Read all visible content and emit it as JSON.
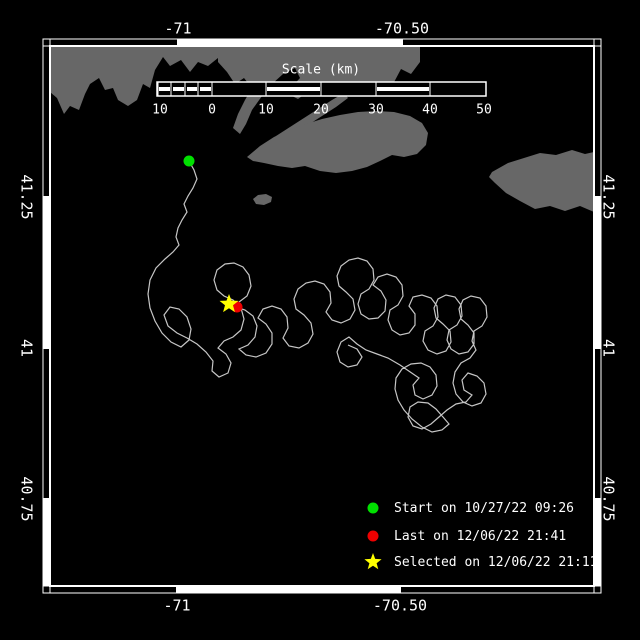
{
  "figure": {
    "background": "#000000",
    "land_color": "#676767",
    "track_color": "#c6c6c6",
    "frame_color": "#ffffff",
    "text_color": "#ffffff"
  },
  "axes": {
    "top": [
      {
        "label": "-71",
        "x": 178
      },
      {
        "label": "-70.50",
        "x": 402
      }
    ],
    "bottom": [
      {
        "label": "-71",
        "x": 177
      },
      {
        "label": "-70.50",
        "x": 400
      }
    ],
    "left": [
      {
        "label": "41.25",
        "y": 197
      },
      {
        "label": "41",
        "y": 348
      },
      {
        "label": "40.75",
        "y": 499
      }
    ],
    "right": [
      {
        "label": "41.25",
        "y": 197
      },
      {
        "label": "41",
        "y": 348
      },
      {
        "label": "40.75",
        "y": 499
      }
    ]
  },
  "border": {
    "frame": {
      "x1": 50,
      "y1": 46,
      "x2": 594,
      "y2": 586
    },
    "band": 7,
    "top": {
      "ticks": [
        178,
        402
      ],
      "white": [
        [
          178,
          402
        ]
      ]
    },
    "bottom": {
      "ticks": [
        177,
        400
      ],
      "white": [
        [
          177,
          400
        ]
      ]
    },
    "left": {
      "ticks": [
        197,
        348,
        499
      ],
      "white": [
        [
          197,
          348
        ],
        [
          499,
          586
        ]
      ]
    },
    "right": {
      "ticks": [
        197,
        348,
        499
      ],
      "white": [
        [
          197,
          348
        ],
        [
          499,
          586
        ]
      ]
    }
  },
  "scalebar": {
    "title": "Scale (km)",
    "title_x": 321,
    "title_y": 70,
    "bar": {
      "x1": 157,
      "y1": 82,
      "x2": 486,
      "y2": 96
    },
    "stripe_y": [
      87,
      91
    ],
    "dividers": [
      158,
      171,
      185,
      198,
      212,
      266,
      321,
      376,
      430
    ],
    "stripes": [
      [
        159,
        170
      ],
      [
        173,
        184
      ],
      [
        187,
        197
      ],
      [
        200,
        211
      ],
      [
        267,
        320
      ],
      [
        377,
        429
      ]
    ],
    "ticks": [
      {
        "label": "10",
        "x": 160
      },
      {
        "label": "0",
        "x": 212
      },
      {
        "label": "10",
        "x": 266
      },
      {
        "label": "20",
        "x": 321
      },
      {
        "label": "30",
        "x": 376
      },
      {
        "label": "40",
        "x": 430
      },
      {
        "label": "50",
        "x": 484
      }
    ],
    "tick_y": 110
  },
  "markers": {
    "start": {
      "x": 189,
      "y": 161,
      "r": 5.5,
      "color": "#00e000"
    },
    "last": {
      "x": 237,
      "y": 307,
      "r": 5.5,
      "color": "#ee0000"
    },
    "selected": {
      "x": 229,
      "y": 304,
      "r": 10,
      "color": "#ffff00"
    }
  },
  "legend": {
    "x": 360,
    "items": [
      {
        "marker": "circle",
        "color": "#00e000",
        "y": 508,
        "label": "Start on 10/27/22 09:26"
      },
      {
        "marker": "circle",
        "color": "#ee0000",
        "y": 536,
        "label": "Last on 12/06/22 21:41"
      },
      {
        "marker": "star",
        "color": "#ffff00",
        "y": 562,
        "label": "Selected on 12/06/22 21:11"
      }
    ]
  },
  "land": [
    {
      "name": "landmass-mainland-west",
      "points": "50,46 218,46 218,58 208,66 198,62 190,72 181,60 170,66 163,57 155,70 150,88 143,84 137,100 128,106 118,100 113,88 105,90 99,78 90,84 85,94 79,110 70,106 64,114 57,98 50,92"
    },
    {
      "name": "landmass-mainland-east",
      "points": "218,46 420,46 420,62 411,74 401,69 392,86 379,91 365,84 350,93 336,88 322,96 309,91 298,99 286,93 300,78 295,68 283,74 272,84 262,96 252,110 246,124 240,134 233,128 238,114 245,100 252,88 244,78 235,84 227,72 218,62"
    },
    {
      "name": "landmass-elizabeth-islands",
      "points": "262,146 276,136 290,127 304,118 318,109 332,100 344,93 348,98 336,107 322,116 308,125 294,134 280,143 268,152"
    },
    {
      "name": "landmass-marthas-vineyard",
      "points": "247,157 260,146 274,137 290,130 306,124 322,119 340,115 358,112 376,111 394,112 410,116 422,123 428,133 426,145 417,154 404,157 392,155 380,161 367,167 352,171 336,173 320,171 305,166 292,168 278,166 264,163 253,161"
    },
    {
      "name": "landmass-nantucket",
      "points": "492,172 508,163 524,158 540,153 556,155 572,150 585,154 594,152 594,212 580,206 565,211 550,206 535,209 520,201 506,193 495,183 489,177"
    },
    {
      "name": "landmass-small-island",
      "points": "253,199 258,195 266,194 272,197 271,202 264,205 256,204"
    }
  ],
  "track": [
    [
      189,
      161
    ],
    [
      194,
      170
    ],
    [
      197,
      179
    ],
    [
      193,
      188
    ],
    [
      188,
      196
    ],
    [
      184,
      204
    ],
    [
      187,
      212
    ],
    [
      182,
      220
    ],
    [
      178,
      228
    ],
    [
      176,
      237
    ],
    [
      179,
      245
    ],
    [
      173,
      252
    ],
    [
      165,
      259
    ],
    [
      156,
      268
    ],
    [
      150,
      280
    ],
    [
      148,
      294
    ],
    [
      150,
      308
    ],
    [
      155,
      321
    ],
    [
      162,
      333
    ],
    [
      171,
      342
    ],
    [
      181,
      347
    ],
    [
      189,
      340
    ],
    [
      191,
      329
    ],
    [
      187,
      317
    ],
    [
      179,
      309
    ],
    [
      170,
      307
    ],
    [
      164,
      315
    ],
    [
      168,
      326
    ],
    [
      177,
      333
    ],
    [
      187,
      338
    ],
    [
      197,
      344
    ],
    [
      206,
      352
    ],
    [
      213,
      361
    ],
    [
      212,
      371
    ],
    [
      219,
      377
    ],
    [
      228,
      373
    ],
    [
      231,
      363
    ],
    [
      226,
      354
    ],
    [
      218,
      348
    ],
    [
      224,
      341
    ],
    [
      233,
      337
    ],
    [
      241,
      330
    ],
    [
      244,
      319
    ],
    [
      241,
      308
    ],
    [
      233,
      300
    ],
    [
      224,
      296
    ],
    [
      217,
      290
    ],
    [
      214,
      280
    ],
    [
      217,
      270
    ],
    [
      225,
      264
    ],
    [
      234,
      263
    ],
    [
      243,
      267
    ],
    [
      249,
      275
    ],
    [
      251,
      286
    ],
    [
      247,
      296
    ],
    [
      239,
      302
    ],
    [
      236,
      307
    ],
    [
      245,
      310
    ],
    [
      253,
      316
    ],
    [
      257,
      326
    ],
    [
      255,
      337
    ],
    [
      248,
      345
    ],
    [
      239,
      349
    ],
    [
      246,
      355
    ],
    [
      256,
      357
    ],
    [
      266,
      353
    ],
    [
      272,
      344
    ],
    [
      272,
      333
    ],
    [
      266,
      324
    ],
    [
      258,
      318
    ],
    [
      263,
      309
    ],
    [
      272,
      306
    ],
    [
      281,
      309
    ],
    [
      287,
      317
    ],
    [
      288,
      328
    ],
    [
      283,
      338
    ],
    [
      289,
      346
    ],
    [
      299,
      348
    ],
    [
      308,
      343
    ],
    [
      313,
      334
    ],
    [
      311,
      323
    ],
    [
      304,
      315
    ],
    [
      296,
      309
    ],
    [
      294,
      299
    ],
    [
      298,
      289
    ],
    [
      306,
      283
    ],
    [
      315,
      281
    ],
    [
      324,
      284
    ],
    [
      330,
      292
    ],
    [
      331,
      303
    ],
    [
      326,
      312
    ],
    [
      332,
      320
    ],
    [
      341,
      323
    ],
    [
      350,
      319
    ],
    [
      355,
      310
    ],
    [
      353,
      299
    ],
    [
      346,
      292
    ],
    [
      339,
      286
    ],
    [
      337,
      276
    ],
    [
      341,
      266
    ],
    [
      349,
      260
    ],
    [
      358,
      258
    ],
    [
      367,
      261
    ],
    [
      373,
      269
    ],
    [
      374,
      280
    ],
    [
      369,
      289
    ],
    [
      361,
      294
    ],
    [
      358,
      304
    ],
    [
      361,
      314
    ],
    [
      369,
      319
    ],
    [
      378,
      318
    ],
    [
      385,
      311
    ],
    [
      386,
      300
    ],
    [
      381,
      291
    ],
    [
      373,
      285
    ],
    [
      378,
      277
    ],
    [
      387,
      274
    ],
    [
      396,
      277
    ],
    [
      402,
      285
    ],
    [
      403,
      296
    ],
    [
      398,
      305
    ],
    [
      390,
      310
    ],
    [
      388,
      320
    ],
    [
      392,
      330
    ],
    [
      400,
      335
    ],
    [
      409,
      333
    ],
    [
      415,
      325
    ],
    [
      415,
      314
    ],
    [
      409,
      306
    ],
    [
      413,
      297
    ],
    [
      422,
      295
    ],
    [
      431,
      298
    ],
    [
      437,
      306
    ],
    [
      438,
      317
    ],
    [
      433,
      326
    ],
    [
      425,
      331
    ],
    [
      423,
      341
    ],
    [
      428,
      350
    ],
    [
      437,
      354
    ],
    [
      446,
      351
    ],
    [
      451,
      342
    ],
    [
      450,
      331
    ],
    [
      443,
      324
    ],
    [
      436,
      318
    ],
    [
      434,
      308
    ],
    [
      438,
      299
    ],
    [
      446,
      295
    ],
    [
      455,
      297
    ],
    [
      461,
      305
    ],
    [
      462,
      316
    ],
    [
      457,
      325
    ],
    [
      449,
      330
    ],
    [
      447,
      340
    ],
    [
      451,
      349
    ],
    [
      459,
      354
    ],
    [
      468,
      352
    ],
    [
      474,
      344
    ],
    [
      474,
      333
    ],
    [
      468,
      325
    ],
    [
      461,
      319
    ],
    [
      459,
      309
    ],
    [
      463,
      300
    ],
    [
      471,
      296
    ],
    [
      480,
      298
    ],
    [
      486,
      306
    ],
    [
      487,
      317
    ],
    [
      482,
      326
    ],
    [
      474,
      331
    ],
    [
      472,
      341
    ],
    [
      476,
      350
    ],
    [
      470,
      358
    ],
    [
      461,
      363
    ],
    [
      455,
      372
    ],
    [
      453,
      383
    ],
    [
      456,
      394
    ],
    [
      463,
      402
    ],
    [
      472,
      406
    ],
    [
      481,
      403
    ],
    [
      486,
      394
    ],
    [
      484,
      383
    ],
    [
      477,
      376
    ],
    [
      468,
      373
    ],
    [
      462,
      380
    ],
    [
      464,
      390
    ],
    [
      472,
      395
    ],
    [
      466,
      402
    ],
    [
      456,
      404
    ],
    [
      447,
      410
    ],
    [
      439,
      417
    ],
    [
      431,
      424
    ],
    [
      422,
      429
    ],
    [
      413,
      426
    ],
    [
      408,
      417
    ],
    [
      410,
      407
    ],
    [
      418,
      402
    ],
    [
      428,
      403
    ],
    [
      436,
      409
    ],
    [
      443,
      417
    ],
    [
      449,
      424
    ],
    [
      442,
      430
    ],
    [
      432,
      432
    ],
    [
      422,
      427
    ],
    [
      412,
      419
    ],
    [
      404,
      410
    ],
    [
      398,
      400
    ],
    [
      395,
      389
    ],
    [
      396,
      378
    ],
    [
      402,
      369
    ],
    [
      411,
      364
    ],
    [
      421,
      363
    ],
    [
      430,
      367
    ],
    [
      436,
      375
    ],
    [
      437,
      386
    ],
    [
      432,
      395
    ],
    [
      423,
      399
    ],
    [
      415,
      395
    ],
    [
      413,
      385
    ],
    [
      419,
      378
    ],
    [
      400,
      365
    ],
    [
      388,
      358
    ],
    [
      377,
      354
    ],
    [
      366,
      350
    ],
    [
      357,
      344
    ],
    [
      349,
      337
    ],
    [
      341,
      342
    ],
    [
      337,
      352
    ],
    [
      340,
      362
    ],
    [
      348,
      367
    ],
    [
      357,
      365
    ],
    [
      362,
      357
    ],
    [
      357,
      349
    ],
    [
      348,
      345
    ]
  ]
}
